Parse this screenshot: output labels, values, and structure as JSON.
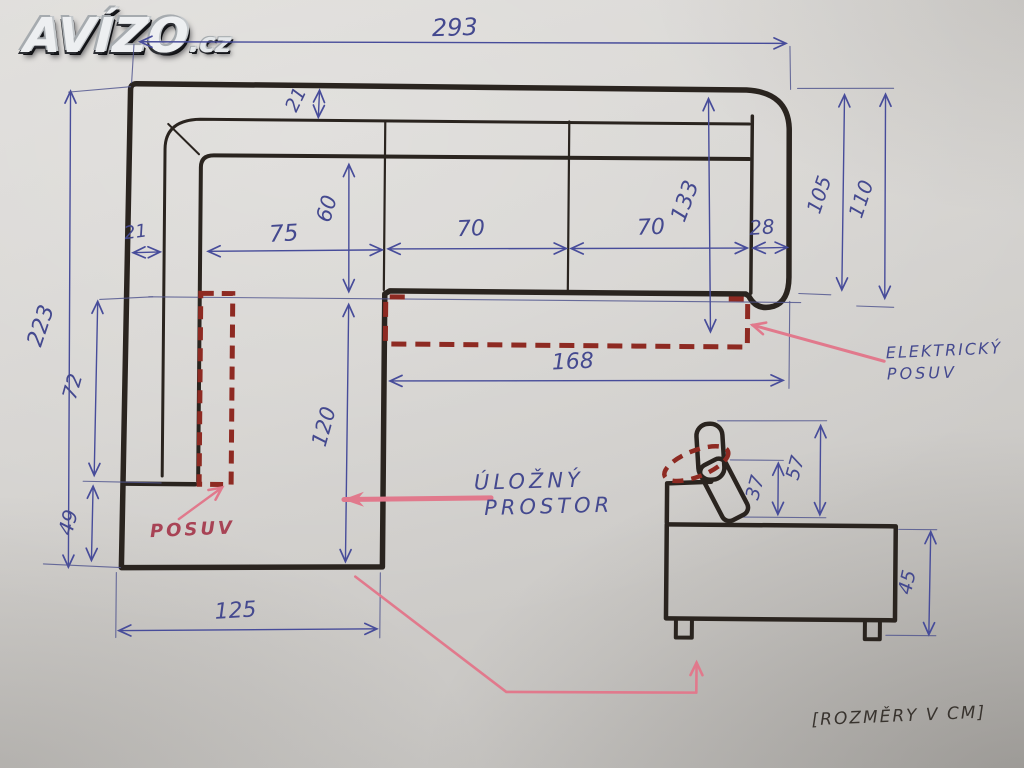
{
  "watermark": {
    "brand": "AVÍZO",
    "suffix": ".cz"
  },
  "note_bottom_right": "[ROZMĚRY V CM]",
  "unit": "cm",
  "labels": {
    "slide_mechanism": "POSUV",
    "storage_space_line1": "ÚLOŽNÝ",
    "storage_space_line2": "PROSTOR",
    "electric_slide_line1": "ELEKTRICKÝ",
    "electric_slide_line2": "POSUV"
  },
  "dimensions_cm": {
    "total_width": "293",
    "total_depth": "223",
    "backrest_depth": "21",
    "left_armrest_width": "21",
    "seat_depth": "60",
    "seat_left_width": "75",
    "seat_mid_width": "70",
    "seat_right_width": "70",
    "right_armrest_width": "28",
    "depth_to_storage": "133",
    "right_depth_inner": "105",
    "right_depth_outer": "110",
    "chaise_side_upper": "72",
    "chaise_side_lower": "49",
    "chaise_inner_length": "120",
    "chaise_width": "125",
    "storage_length": "168",
    "headrest_lower": "37",
    "headrest_total": "57",
    "seat_body_height": "45"
  },
  "colors": {
    "ink_blue": "#474c9a",
    "marker_red": "#8e2a22",
    "arrow_pink": "#e1798c",
    "pencil_dark": "#2a241f",
    "paper": "#d2d0cc"
  }
}
